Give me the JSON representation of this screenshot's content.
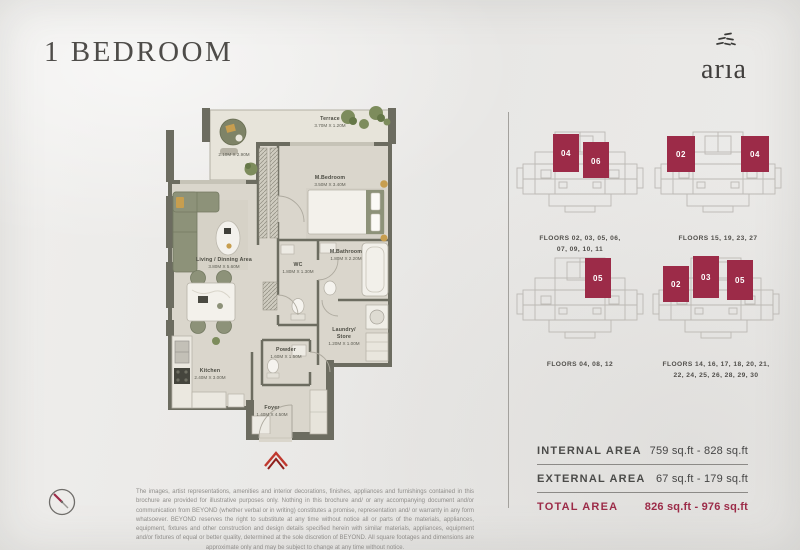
{
  "page": {
    "title": "1 BEDROOM",
    "brand_wordmark": "arıa"
  },
  "floorplan": {
    "terrace": {
      "name": "Terrace",
      "dims": "3.70M X 1.20M"
    },
    "balcony": {
      "dims": "2.10M X 2.90M"
    },
    "bedroom": {
      "name": "M.Bedroom",
      "dims": "3.50M X 3.40M"
    },
    "living": {
      "name": "Living / Dinning Area",
      "dims": "3.80M X 5.60M"
    },
    "wc": {
      "name": "WC",
      "dims": "1.80M X 1.30M"
    },
    "bathroom": {
      "name": "M.Bathroom",
      "dims": "1.80M X 2.20M"
    },
    "laundry": {
      "name": "Laundry/",
      "name2": "Store",
      "dims": "1.20M X 1.00M"
    },
    "powder": {
      "name": "Powder",
      "dims": "1.60M X 1.50M"
    },
    "kitchen": {
      "name": "Kitchen",
      "dims": "2.40M X 3.00M"
    },
    "foyer": {
      "name": "Foyer",
      "dims": "1.40M X 4.50M"
    }
  },
  "key_plans": [
    {
      "units": [
        "04",
        "06"
      ],
      "floors_lines": [
        "FLOORS 02, 03, 05, 06,",
        "07, 09, 10, 11"
      ]
    },
    {
      "units": [
        "02",
        "04"
      ],
      "floors_lines": [
        "FLOORS 15, 19, 23, 27"
      ]
    },
    {
      "units": [
        "05"
      ],
      "floors_lines": [
        "FLOORS 04, 08, 12"
      ]
    },
    {
      "units": [
        "02",
        "03",
        "05"
      ],
      "floors_lines": [
        "FLOORS 14, 16, 17, 18, 20, 21,",
        "22, 24, 25, 26, 28, 29, 30"
      ]
    }
  ],
  "area_table": {
    "rows": [
      {
        "label": "INTERNAL AREA",
        "value": "759 sq.ft - 828 sq.ft"
      },
      {
        "label": "EXTERNAL AREA",
        "value": "67 sq.ft - 179 sq.ft"
      },
      {
        "label": "TOTAL AREA",
        "value": "826 sq.ft - 976 sq.ft"
      }
    ]
  },
  "disclaimer": {
    "text": "The images, artist representations, amenities and interior decorations, finishes, appliances and furnishings contained in this brochure are provided for illustrative purposes only. Nothing in this brochure and/ or any accompanying document and/or communication from BEYOND (whether verbal or in writing) constitutes a promise, representation and/ or warranty in any form whatsoever. BEYOND reserves the right to substitute at any time without notice all or parts of the materials, appliances, equipment, fixtures and other construction and design details specified herein with similar materials, appliances, equipment and/or fixtures of equal or better quality, determined at the sole discretion of BEYOND. All square footages and dimensions are approximate only and may be subject to change at any time without notice."
  },
  "colors": {
    "accent": "#9c2b48",
    "wall": "#6c6c60",
    "floor": "#dad6cc",
    "terrace": "#e7e4da",
    "entry": "#c0392f"
  }
}
